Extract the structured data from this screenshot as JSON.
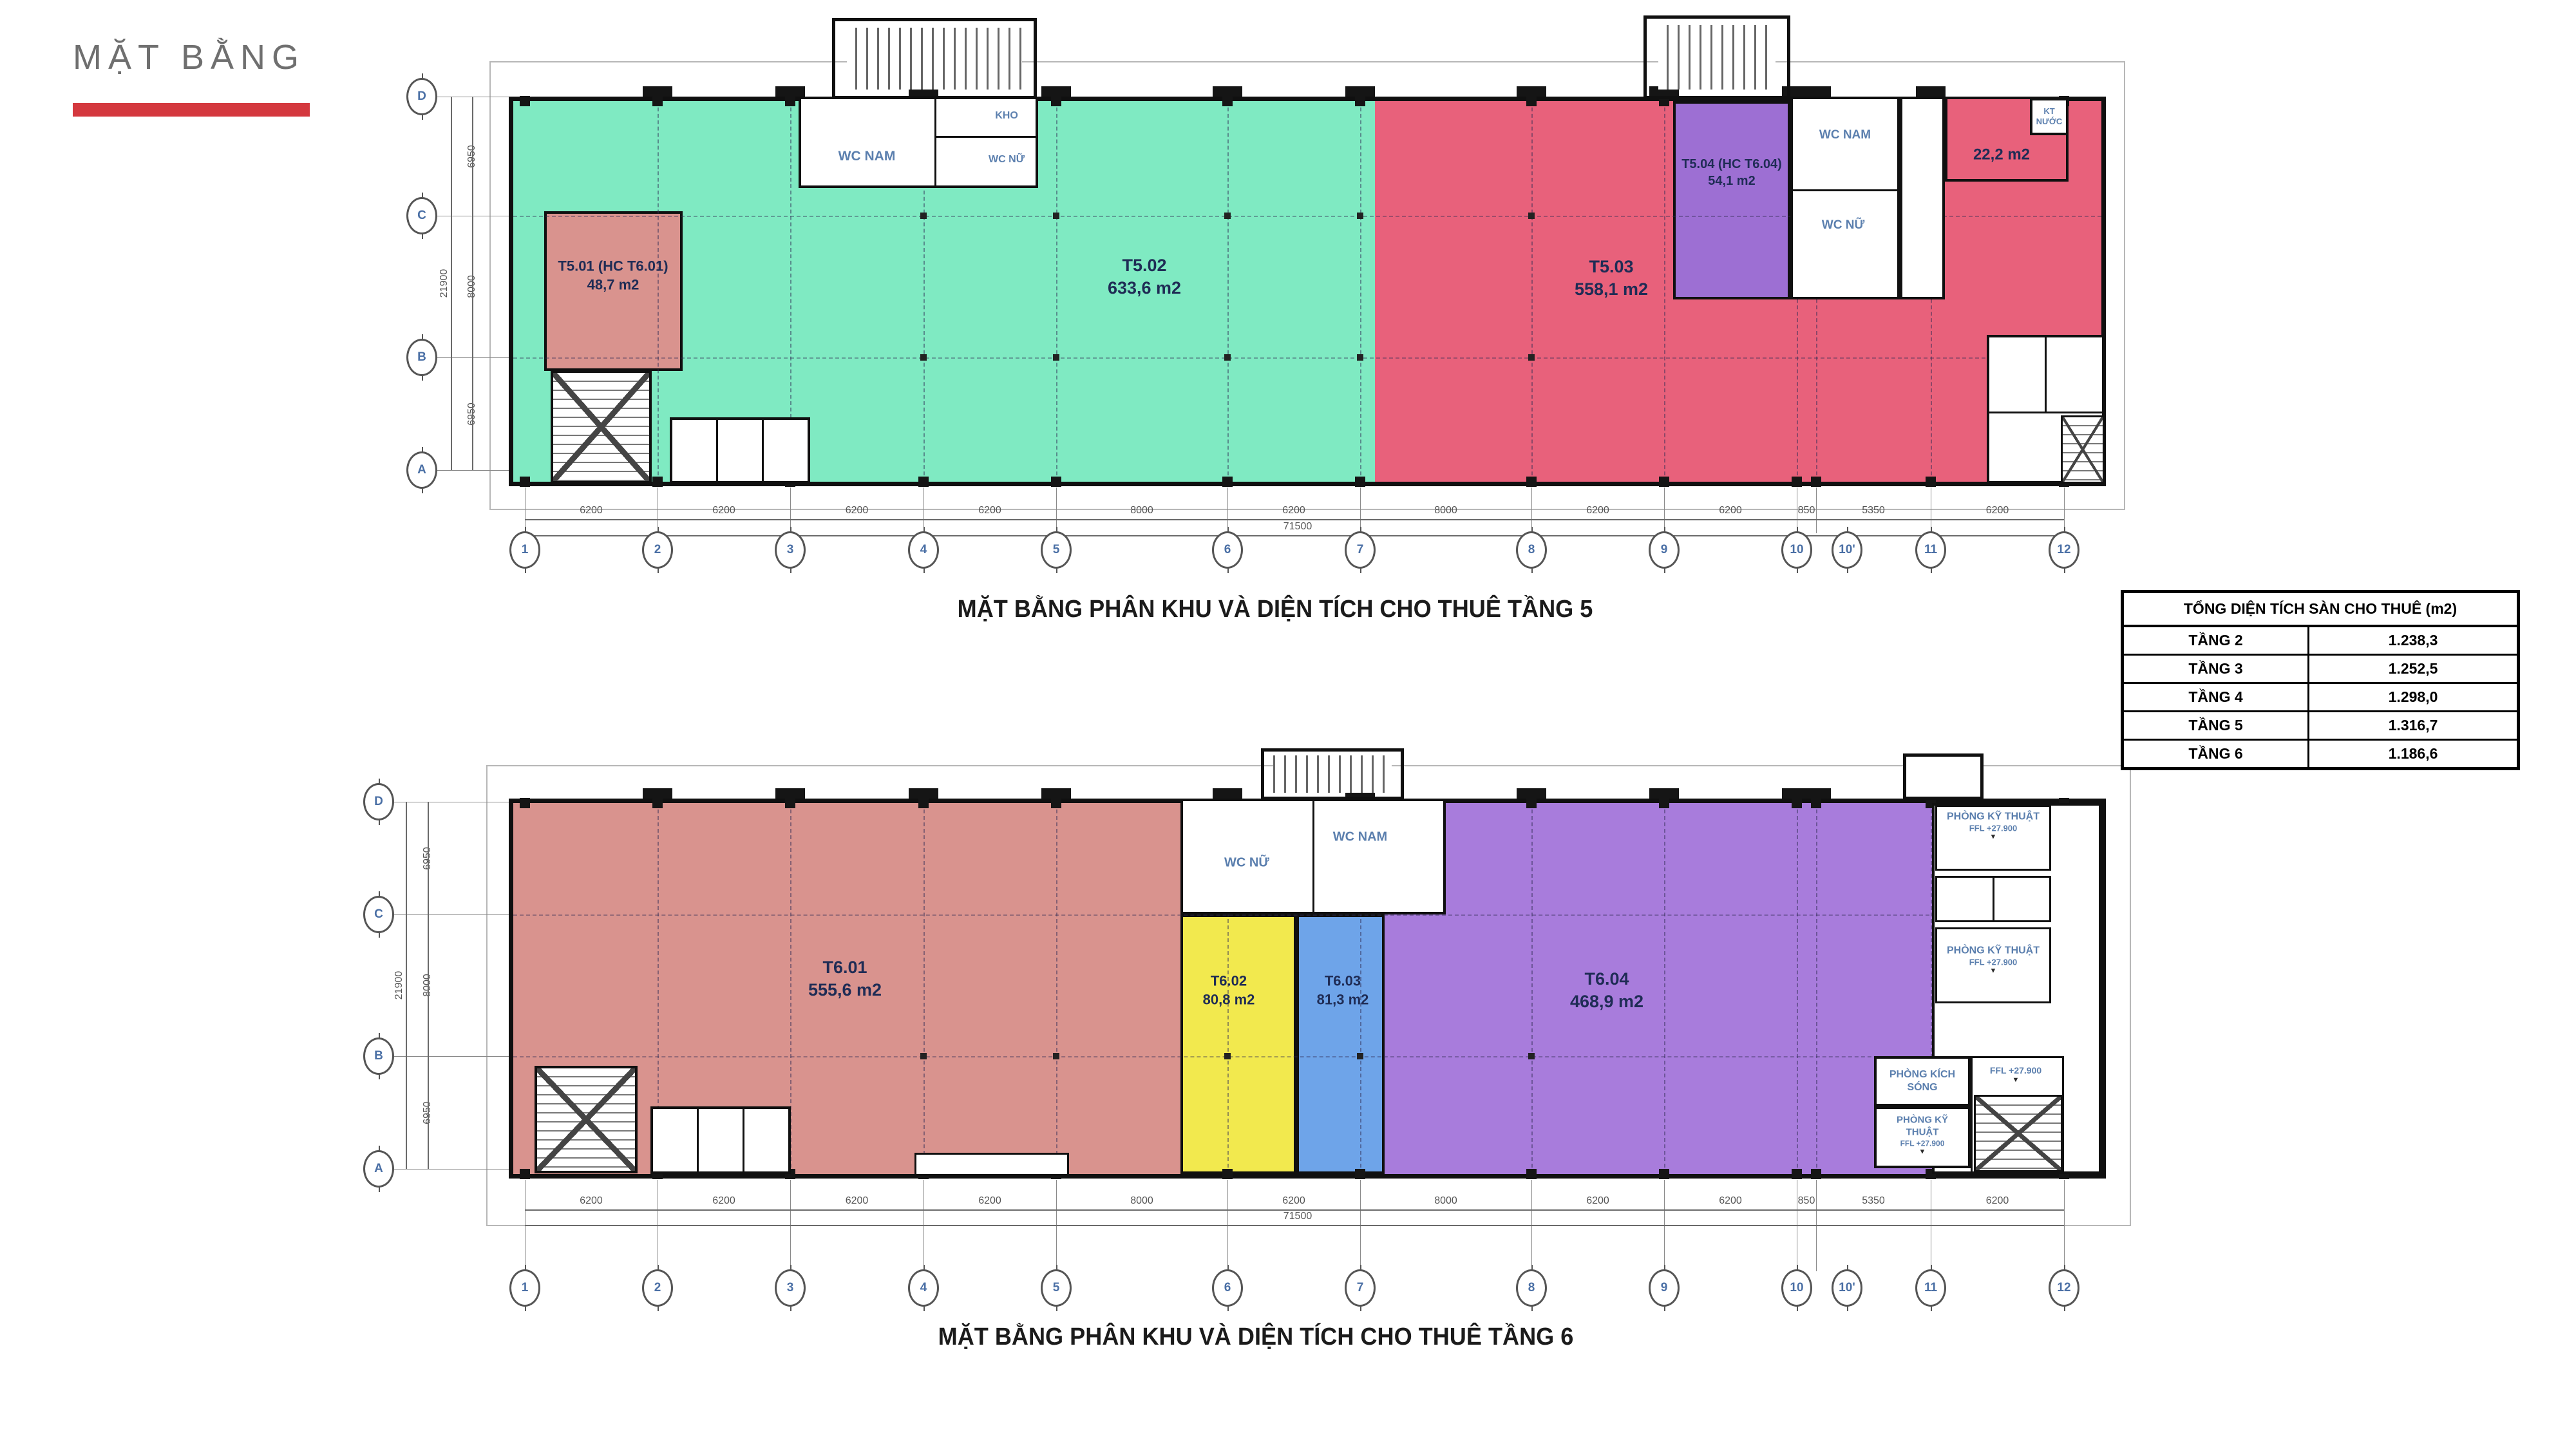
{
  "header": {
    "title": "MẶT BẰNG",
    "accent_color": "#d4383e"
  },
  "floor5": {
    "caption": "MẶT BẰNG PHÂN KHU VÀ DIỆN TÍCH CHO THUÊ TẦNG 5",
    "zones": [
      {
        "code": "T5.01 (HC T6.01)",
        "area": "48,7 m2",
        "color": "#d9938e"
      },
      {
        "code": "T5.02",
        "area": "633,6 m2",
        "color": "#7feac2"
      },
      {
        "code": "T5.03",
        "area": "558,1 m2",
        "color": "#e8617b"
      },
      {
        "code": "T5.04 (HC T6.04)",
        "area": "54,1 m2",
        "color": "#9d6fd3"
      },
      {
        "code": "",
        "area": "22,2 m2",
        "color": "#e8617b"
      }
    ],
    "rooms": {
      "wc_nam": "WC NAM",
      "wc_nu": "WC NỮ",
      "kho": "KHO",
      "kt_nuoc": "KT NƯỚC"
    },
    "grid": {
      "cols": [
        "1",
        "2",
        "3",
        "4",
        "5",
        "6",
        "7",
        "8",
        "9",
        "10",
        "10'",
        "11",
        "12"
      ],
      "col_dims": [
        "6200",
        "6200",
        "6200",
        "6200",
        "8000",
        "6200",
        "8000",
        "6200",
        "6200",
        "850",
        "5350",
        "6200"
      ],
      "col_total": "71500",
      "rows": [
        "D",
        "C",
        "B",
        "A"
      ],
      "row_dims": [
        "6950",
        "8000",
        "6950"
      ],
      "row_total": "21900"
    }
  },
  "summary_table": {
    "title": "TỔNG DIỆN TÍCH SÀN CHO THUÊ (m2)",
    "rows": [
      [
        "TẦNG 2",
        "1.238,3"
      ],
      [
        "TẦNG 3",
        "1.252,5"
      ],
      [
        "TẦNG 4",
        "1.298,0"
      ],
      [
        "TẦNG 5",
        "1.316,7"
      ],
      [
        "TẦNG 6",
        "1.186,6"
      ]
    ]
  },
  "floor6": {
    "caption": "MẶT BẰNG PHÂN KHU VÀ DIỆN TÍCH CHO THUÊ TẦNG 6",
    "zones": [
      {
        "code": "T6.01",
        "area": "555,6 m2",
        "color": "#d9938e"
      },
      {
        "code": "T6.02",
        "area": "80,8 m2",
        "color": "#f2e94e"
      },
      {
        "code": "T6.03",
        "area": "81,3 m2",
        "color": "#6ea4e9"
      },
      {
        "code": "T6.04",
        "area": "468,9 m2",
        "color": "#a87cdc"
      }
    ],
    "rooms": {
      "wc_nam": "WC NAM",
      "wc_nu": "WC NỮ",
      "ky_thuat": "PHÒNG KỸ THUẬT",
      "kich_song": "PHÒNG KÍCH SÓNG",
      "ffl": "FFL +27.900"
    },
    "grid": {
      "cols": [
        "1",
        "2",
        "3",
        "4",
        "5",
        "6",
        "7",
        "8",
        "9",
        "10",
        "10'",
        "11",
        "12"
      ],
      "col_dims": [
        "6200",
        "6200",
        "6200",
        "6200",
        "8000",
        "6200",
        "8000",
        "6200",
        "6200",
        "850",
        "5350",
        "6200"
      ],
      "col_total": "71500",
      "rows": [
        "D",
        "C",
        "B",
        "A"
      ],
      "row_dims": [
        "6950",
        "8000",
        "6950"
      ],
      "row_total": "21900"
    }
  }
}
